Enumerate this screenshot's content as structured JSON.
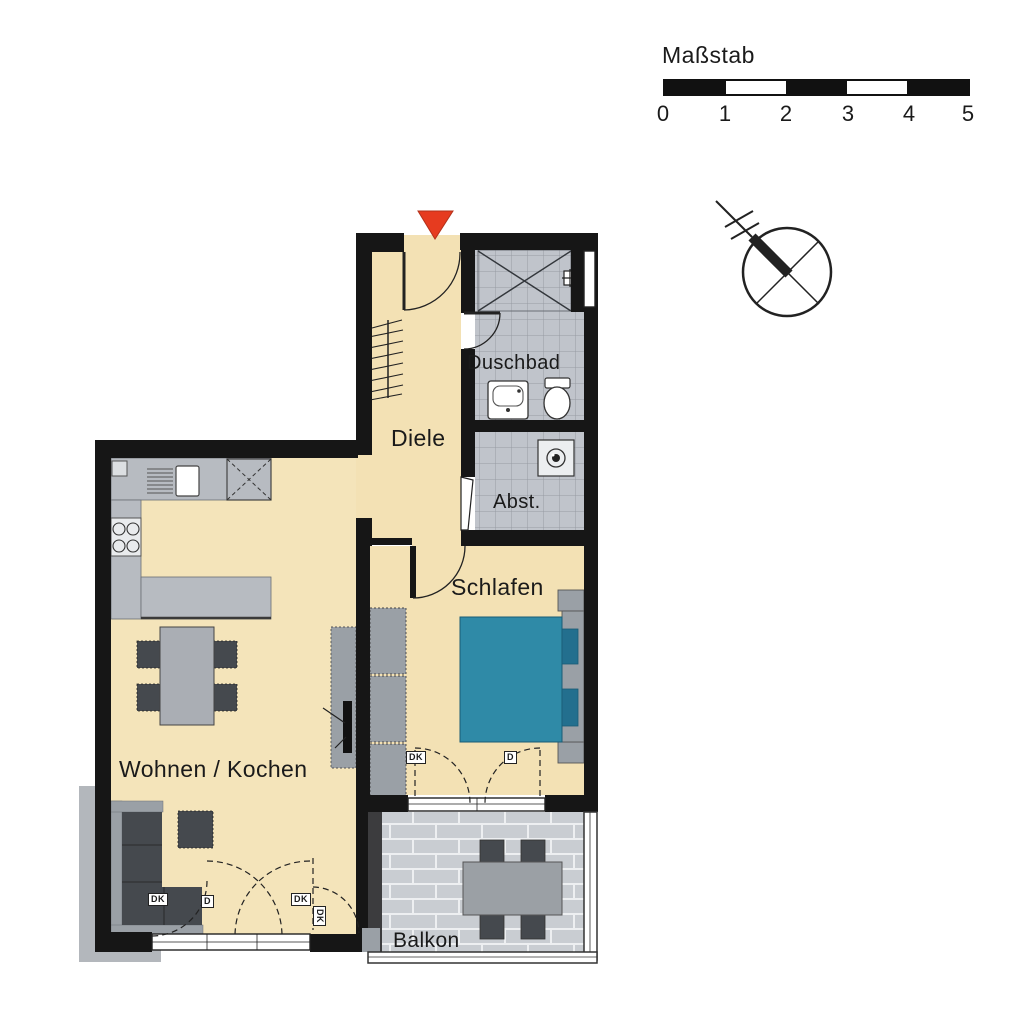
{
  "scale_bar": {
    "title": "Maßstab",
    "ticks": [
      "0",
      "1",
      "2",
      "3",
      "4",
      "5"
    ]
  },
  "rooms": {
    "duschbad": "Duschbad",
    "abstellraum": "Abst.",
    "diele": "Diele",
    "schlafen": "Schlafen",
    "wohnen_kochen": "Wohnen / Kochen",
    "balkon": "Balkon"
  },
  "window_markers": [
    {
      "label": "DK"
    },
    {
      "label": "D"
    },
    {
      "label": "DK"
    },
    {
      "label": "DK"
    },
    {
      "label": "DK"
    },
    {
      "label": "D"
    }
  ],
  "colors": {
    "wall": "#161616",
    "floor": "#f3e1b4",
    "tile": "#c0c4cb",
    "balcony_tile": "#c9cdd2",
    "furniture_light": "#9aa0a6",
    "furniture_dark": "#45494e",
    "bed": "#2f8aa7",
    "entrance_marker": "#e63b1f"
  }
}
